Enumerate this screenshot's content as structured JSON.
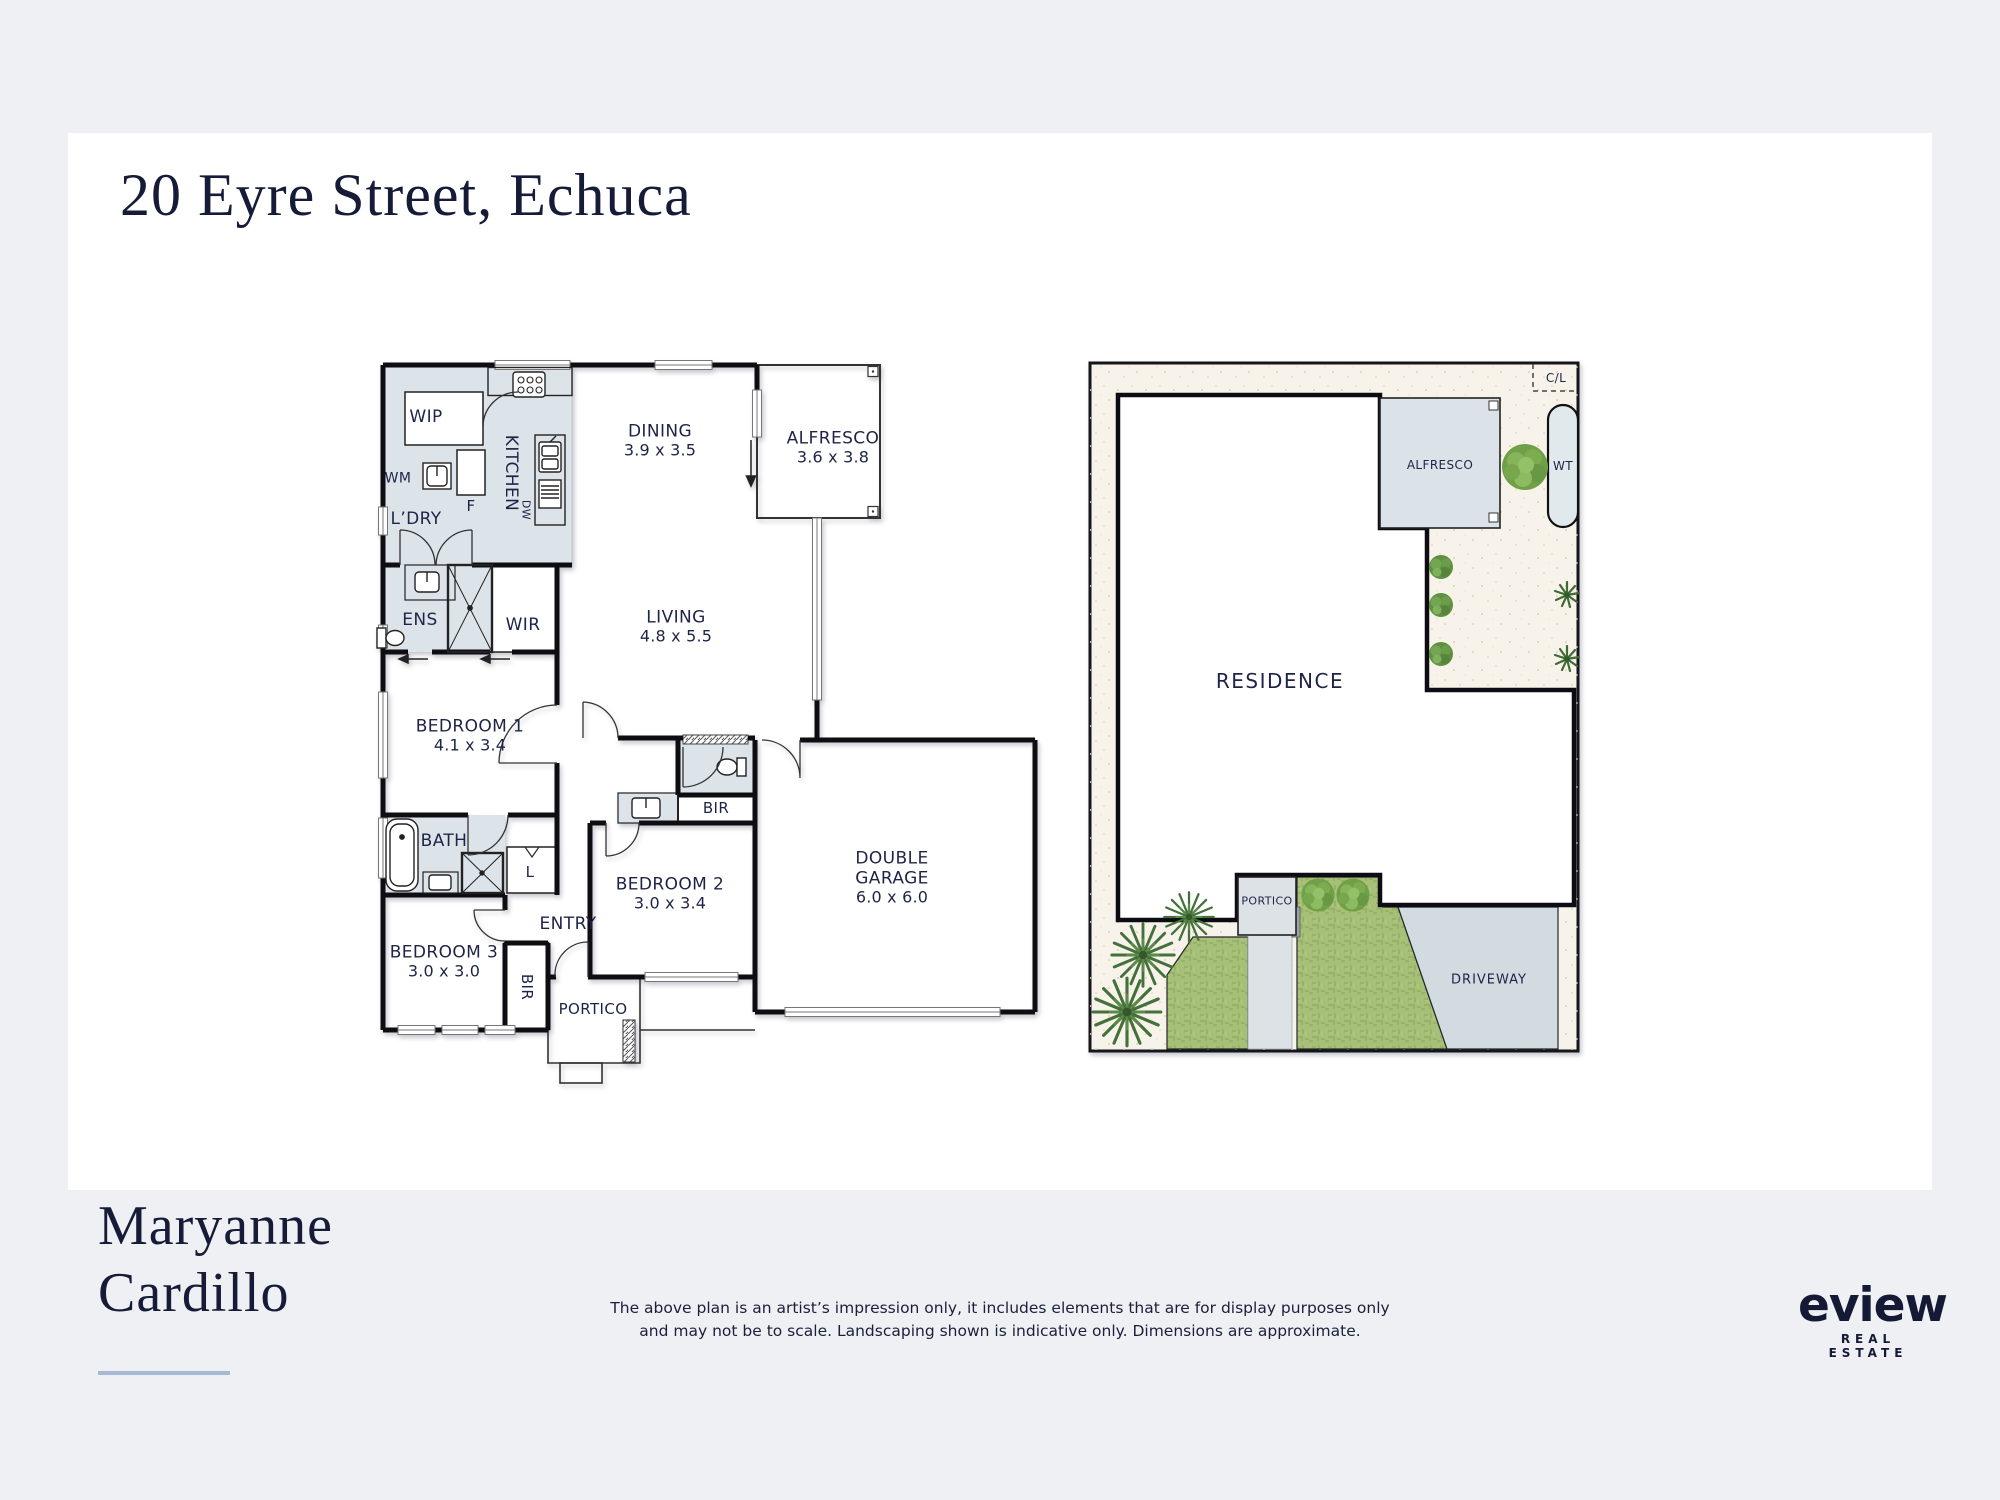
{
  "page": {
    "title": "20 Eyre Street, Echuca",
    "agent": {
      "first": "Maryanne",
      "last": "Cardillo"
    },
    "disclaimer_line1": "The above plan is an artist’s impression only, it includes elements that are for display purposes only",
    "disclaimer_line2": "and may not be to scale. Landscaping shown is indicative only.  Dimensions are approximate.",
    "logo": {
      "name": "eview",
      "tagline": "REAL ESTATE"
    }
  },
  "floorplan": {
    "rooms": {
      "wip": "WIP",
      "kitchen": "KITCHEN",
      "dw": "DW",
      "fridge": "F",
      "wm": "WM",
      "ldry": "L’DRY",
      "dining": {
        "name": "DINING",
        "dims": "3.9 x 3.5"
      },
      "alfresco": {
        "name": "ALFRESCO",
        "dims": "3.6 x 3.8"
      },
      "living": {
        "name": "LIVING",
        "dims": "4.8 x 5.5"
      },
      "ens": "ENS",
      "wir": "WIR",
      "bed1": {
        "name": "BEDROOM 1",
        "dims": "4.1 x 3.4"
      },
      "bath": "BATH",
      "linen": "L",
      "entry": "ENTRY",
      "bed3": {
        "name": "BEDROOM 3",
        "dims": "3.0 x 3.0"
      },
      "bir3": "BIR",
      "portico": "PORTICO",
      "bed2": {
        "name": "BEDROOM 2",
        "dims": "3.0 x 3.4"
      },
      "bir2": "BIR",
      "garage": {
        "name1": "DOUBLE",
        "name2": "GARAGE",
        "dims": "6.0 x 6.0"
      }
    }
  },
  "siteplan": {
    "labels": {
      "cl": "C/L",
      "alfresco": "ALFRESCO",
      "wt": "WT",
      "residence": "RESIDENCE",
      "portico": "PORTICO",
      "driveway": "DRIVEWAY"
    }
  },
  "colors": {
    "navy_text": "#1e2447",
    "wall_black": "#0d0d12",
    "wet_area_fill": "#dde4e9",
    "site_ground": "#f8f3ea",
    "grass_green": "#a7c078",
    "driveway_grey": "#d2dbe0",
    "underline_blue": "#a5bad2",
    "page_grey": "#eff0f3"
  }
}
